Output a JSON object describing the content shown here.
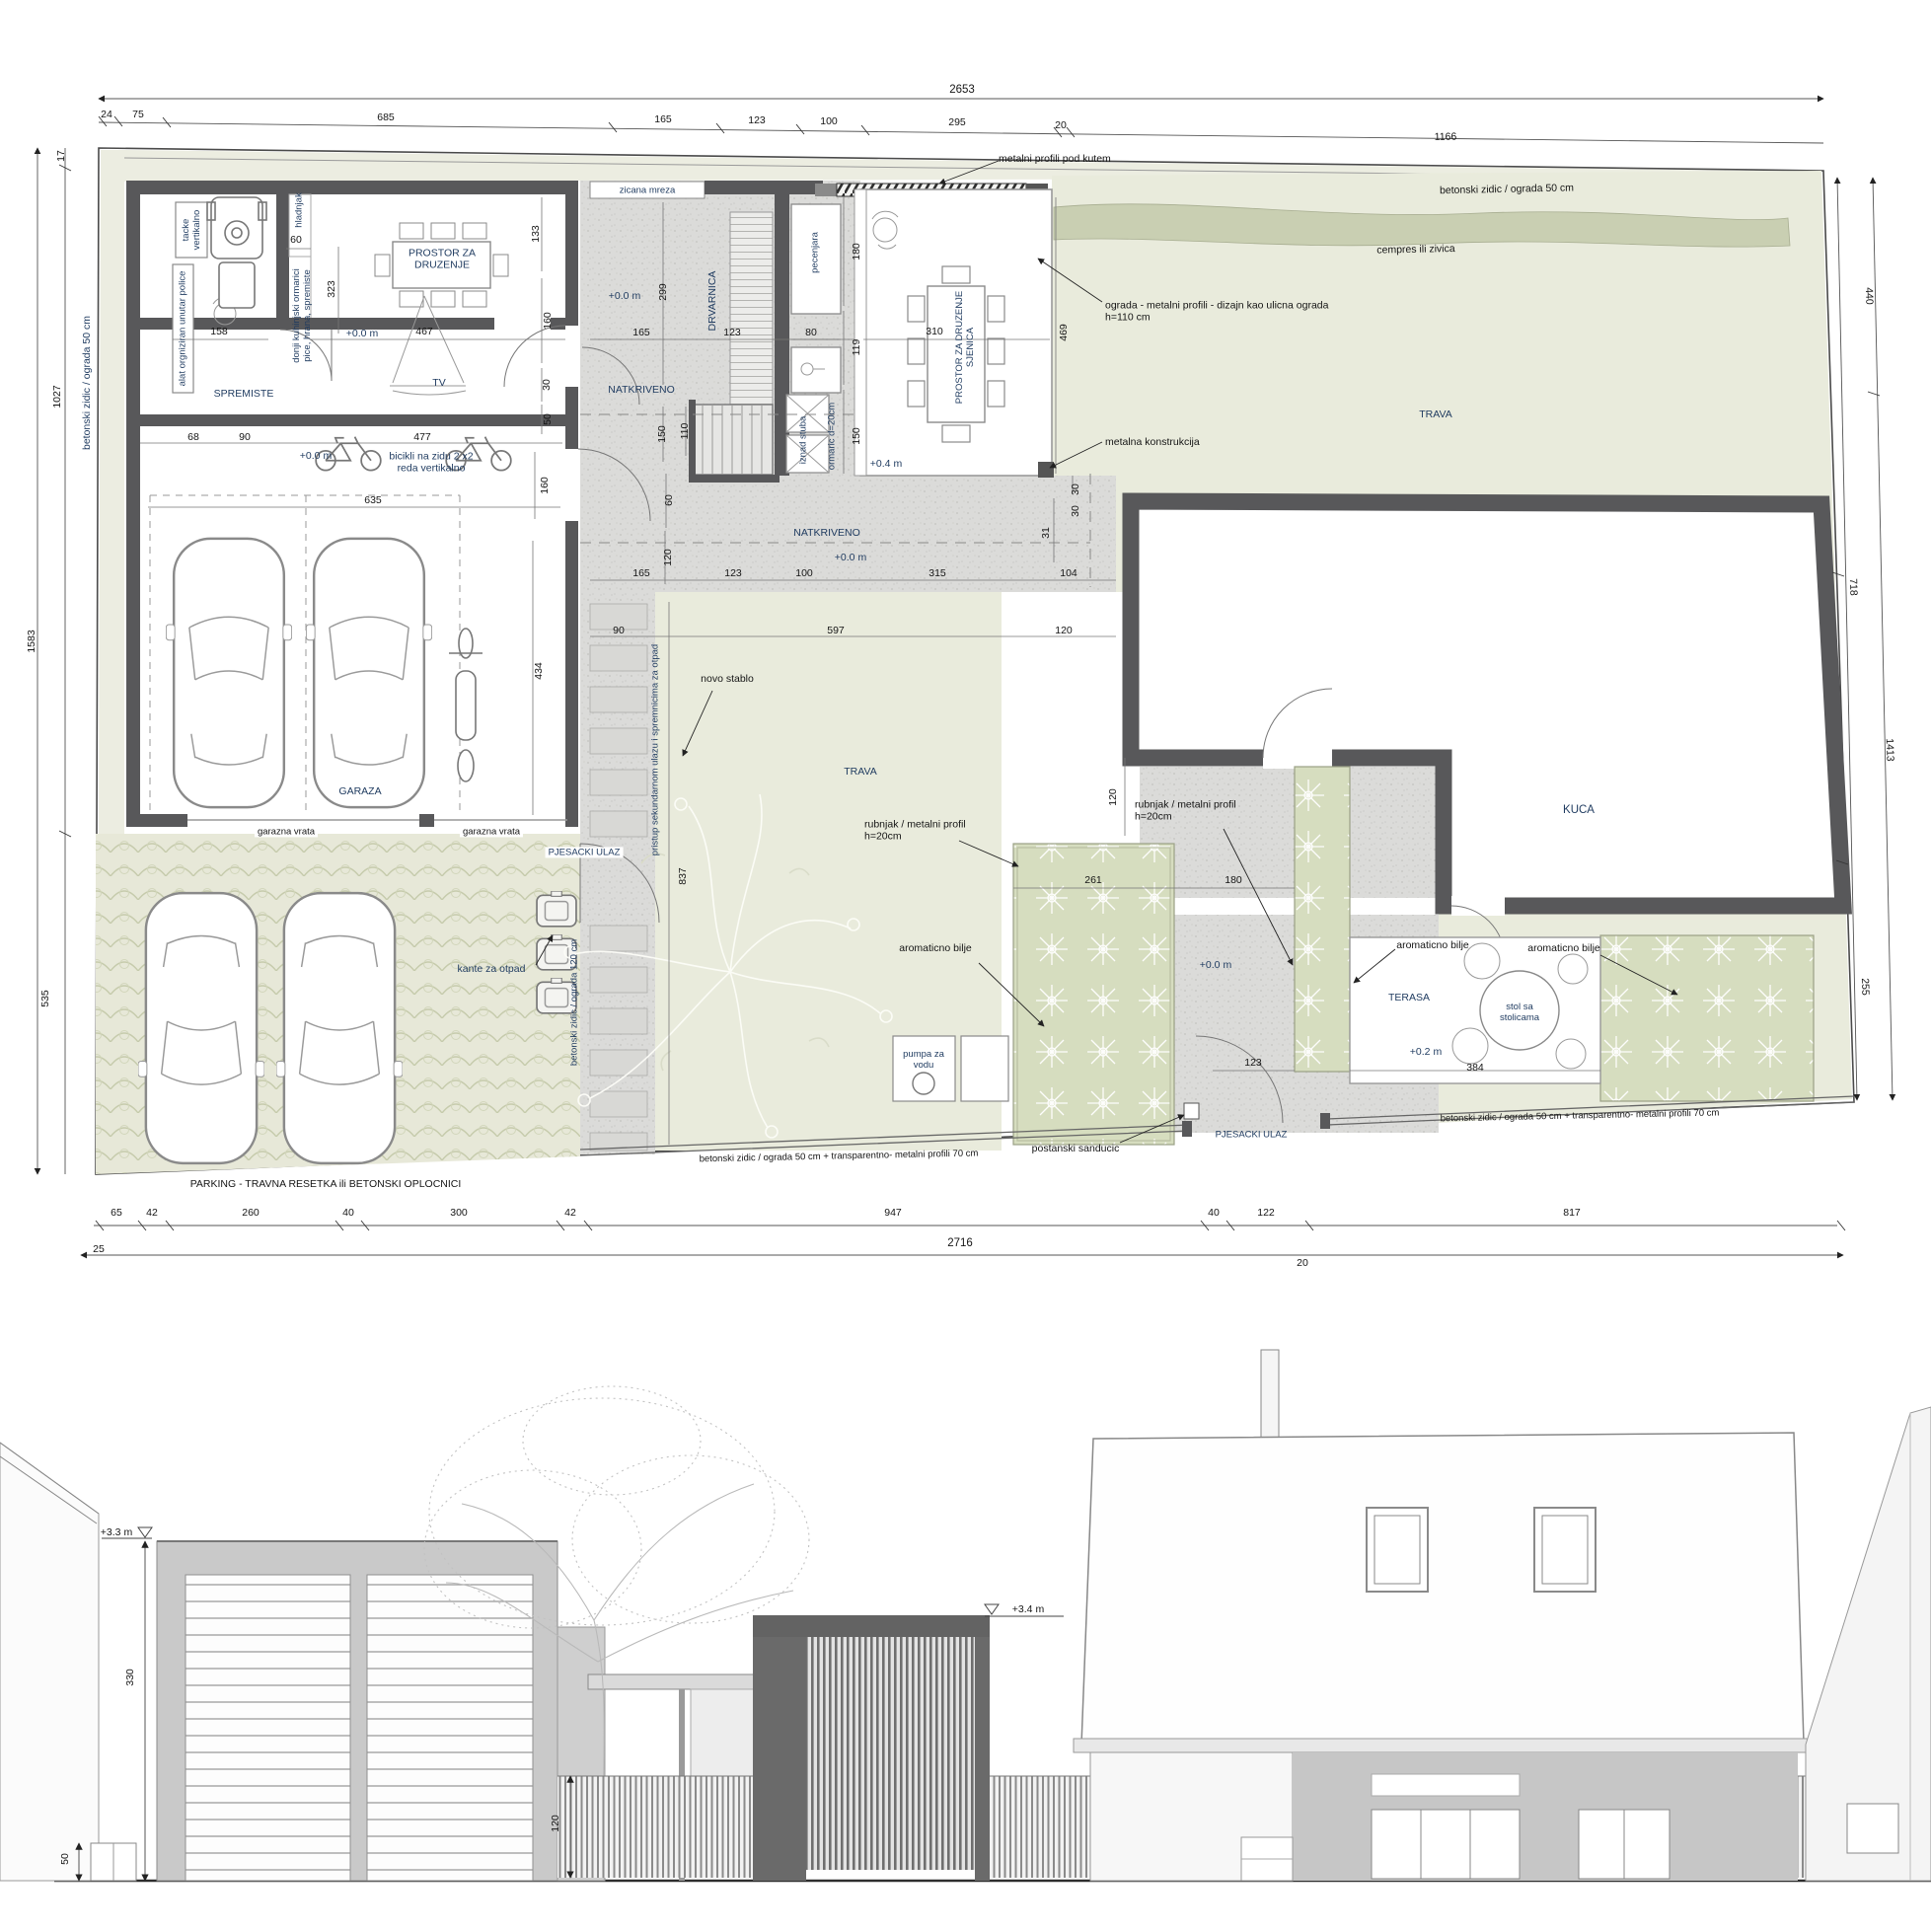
{
  "colors": {
    "wall": "#58585a",
    "concrete": "#dbdbd9",
    "lawn": "#e9ebdc",
    "hedge": "#c9cfb2",
    "bed": "#d6ddbf",
    "label_accent": "#1e3a5f"
  },
  "plan": {
    "totals": {
      "top": "2653",
      "bottom": "2716",
      "bottom_left": "25",
      "bottom_right": "20"
    },
    "top_segments": [
      "24",
      "75",
      "685",
      "165",
      "123",
      "100",
      "295",
      "20",
      "1166"
    ],
    "bottom_segments": [
      "65",
      "42",
      "260",
      "40",
      "300",
      "42",
      "947",
      "40",
      "122",
      "817"
    ],
    "left_dims": [
      "17",
      "1027",
      "1583",
      "535"
    ],
    "right_dims": [
      "440",
      "1413",
      "718",
      "255"
    ],
    "boundary": {
      "left_wall": "betonski zidic / ograda 50 cm",
      "top_wall": "betonski zidic / ograda 50 cm",
      "street_fence": "betonski zidic / ograda 50 cm + transparentno- metalni profili 70 cm",
      "side_fence": "betonski zidic / ograda 120 cm",
      "parking_note": "PARKING - TRAVNA RESETKA ili BETONSKI OPLOCNICI"
    },
    "annotations": {
      "metal_profiles": "metalni profili pod kutem",
      "wire_mesh": "zicana mreza",
      "hedge": "cempres ili zivica",
      "street_fence_design": "ograda - metalni profili - dizajn kao ulicna ograda\nh=110 cm",
      "metal_structure": "metalna konstrukcija",
      "curb": "rubnjak / metalni profil\nh=20cm",
      "aromatic": "aromaticno bilje",
      "new_tree": "novo stablo",
      "mailbox": "postanski sanducic",
      "trash_bins": "kante za otpad",
      "bikes": "bicikli na zidu 2 x2\nreda vertikalno",
      "access_path": "pristup sekundarnom ulazu i spremnicima za otpad"
    },
    "rooms": {
      "social": "PROSTOR ZA\nDRUZENJE",
      "storage": "SPREMISTE",
      "tv": "TV",
      "garage": "GARAZA",
      "garage_door": "garazna vrata",
      "fridge": "hladnjak",
      "kitchen_cabinet": "donji kuhinjski ormarici\npice, hrana, spremiste",
      "tools": "alat orgniziran unutar police",
      "trays": "tacke\nvertikalno",
      "wood_storage": "DRVARNICA",
      "bbq": "pecenjara",
      "above_stairs": "iznad stuba",
      "cabinet": "ormaric d=20cm",
      "gazebo": "PROSTOR ZA DRUZENJE\nSJENICA",
      "covered": "NATKRIVENO",
      "lawn": "TRAVA",
      "house": "KUCA",
      "terrace": "TERASA",
      "terrace_table": "stol sa\nstolicama",
      "pump": "pumpa za\nvodu",
      "pedestrian_entrance": "PJESACKI ULAZ"
    },
    "levels": {
      "zero": "+0.0 m",
      "plus04": "+0.4 m",
      "plus02": "+0.2 m"
    },
    "inner_dims": {
      "d60": "60",
      "d323": "323",
      "d158": "158",
      "d467": "467",
      "d133": "133",
      "d160a": "160",
      "d30a": "30",
      "d50a": "50",
      "d68": "68",
      "d90a": "90",
      "d477": "477",
      "d635": "635",
      "d160b": "160",
      "d434": "434",
      "d299": "299",
      "d165a": "165",
      "d123a": "123",
      "d150a": "150",
      "d110": "110",
      "d60b": "60",
      "d120a": "120",
      "d180a": "180",
      "d80": "80",
      "d119": "119",
      "d150b": "150",
      "d310": "310",
      "d469": "469",
      "d165b": "165",
      "d123b": "123",
      "d100": "100",
      "d315": "315",
      "d104": "104",
      "d31": "31",
      "d30b": "30",
      "d30c": "30",
      "d90b": "90",
      "d597": "597",
      "d120b": "120",
      "d837": "837",
      "d120c": "120",
      "d261": "261",
      "d180b": "180",
      "d123c": "123",
      "d384": "384"
    }
  },
  "elevation": {
    "level_garage": "+3.3 m",
    "level_gazebo": "+3.4 m",
    "dims": {
      "d330": "330",
      "d50": "50",
      "d120": "120"
    }
  }
}
